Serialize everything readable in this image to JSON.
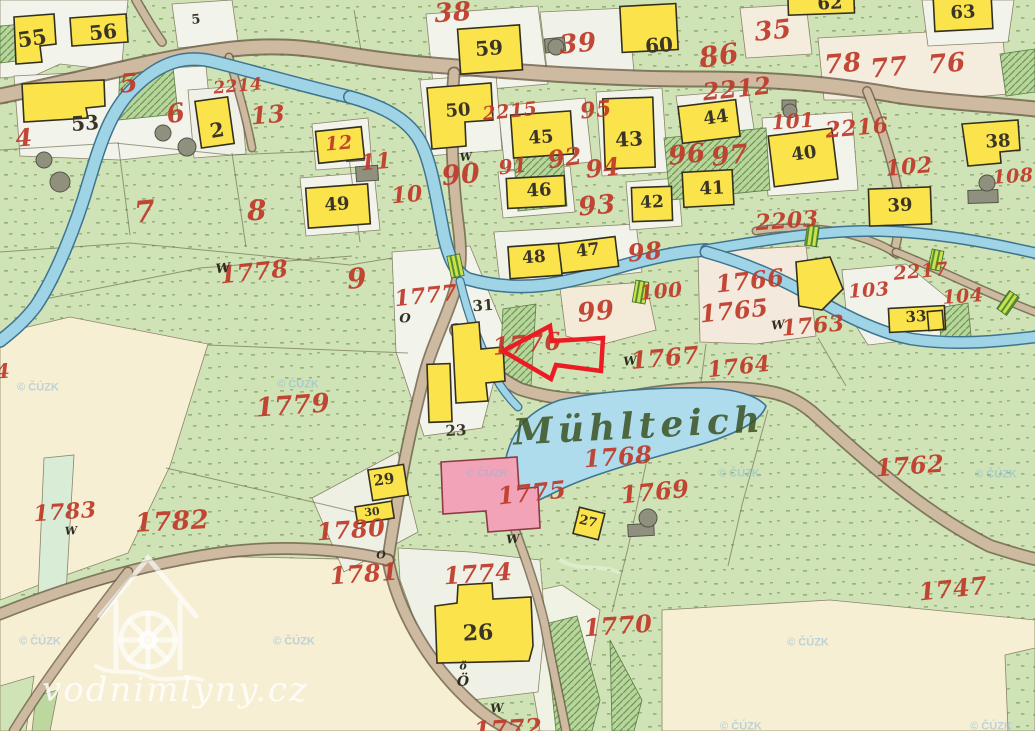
{
  "map": {
    "title": "Historical cadastral map sheet (Mühlteich mill pond)",
    "watermark": {
      "site": "vodnimlyny.cz",
      "copyright": "© ČÚZK"
    },
    "labels": {
      "red": [
        {
          "t": "38",
          "x": 453,
          "y": 13,
          "s": 26,
          "r": -4
        },
        {
          "t": "39",
          "x": 578,
          "y": 44,
          "s": 26,
          "r": -5
        },
        {
          "t": "35",
          "x": 773,
          "y": 31,
          "s": 26,
          "r": -6
        },
        {
          "t": "86",
          "x": 719,
          "y": 56,
          "s": 28,
          "r": -8
        },
        {
          "t": "78",
          "x": 843,
          "y": 64,
          "s": 26,
          "r": -5
        },
        {
          "t": "77",
          "x": 889,
          "y": 68,
          "s": 26,
          "r": -5
        },
        {
          "t": "76",
          "x": 947,
          "y": 64,
          "s": 26,
          "r": -5
        },
        {
          "t": "2212",
          "x": 737,
          "y": 89,
          "s": 24,
          "r": -6
        },
        {
          "t": "5",
          "x": 129,
          "y": 84,
          "s": 26,
          "r": -5
        },
        {
          "t": "2214",
          "x": 238,
          "y": 87,
          "s": 17,
          "r": -5
        },
        {
          "t": "13",
          "x": 268,
          "y": 115,
          "s": 24,
          "r": -5
        },
        {
          "t": "6",
          "x": 176,
          "y": 114,
          "s": 26,
          "r": -8
        },
        {
          "t": "12",
          "x": 339,
          "y": 144,
          "s": 19,
          "r": -5
        },
        {
          "t": "11",
          "x": 376,
          "y": 162,
          "s": 22,
          "r": -5
        },
        {
          "t": "10",
          "x": 407,
          "y": 195,
          "s": 22,
          "r": -5
        },
        {
          "t": "4",
          "x": 24,
          "y": 138,
          "s": 24,
          "r": -5
        },
        {
          "t": "7",
          "x": 145,
          "y": 213,
          "s": 30,
          "r": -5
        },
        {
          "t": "8",
          "x": 257,
          "y": 211,
          "s": 28,
          "r": -3
        },
        {
          "t": "9",
          "x": 357,
          "y": 279,
          "s": 28,
          "r": -5
        },
        {
          "t": "2215",
          "x": 510,
          "y": 112,
          "s": 19,
          "r": -6
        },
        {
          "t": "95",
          "x": 596,
          "y": 110,
          "s": 22,
          "r": -6
        },
        {
          "t": "92",
          "x": 565,
          "y": 158,
          "s": 24,
          "r": -8
        },
        {
          "t": "94",
          "x": 603,
          "y": 168,
          "s": 24,
          "r": -6
        },
        {
          "t": "91",
          "x": 513,
          "y": 166,
          "s": 20,
          "r": -6
        },
        {
          "t": "90",
          "x": 461,
          "y": 175,
          "s": 27,
          "r": -5
        },
        {
          "t": "93",
          "x": 597,
          "y": 206,
          "s": 26,
          "r": -5
        },
        {
          "t": "96",
          "x": 687,
          "y": 155,
          "s": 26,
          "r": -6
        },
        {
          "t": "97",
          "x": 730,
          "y": 156,
          "s": 26,
          "r": -6
        },
        {
          "t": "101",
          "x": 793,
          "y": 121,
          "s": 20,
          "r": -4
        },
        {
          "t": "2216",
          "x": 857,
          "y": 128,
          "s": 22,
          "r": -5
        },
        {
          "t": "102",
          "x": 909,
          "y": 167,
          "s": 22,
          "r": -5
        },
        {
          "t": "108",
          "x": 1013,
          "y": 177,
          "s": 19,
          "r": -4
        },
        {
          "t": "2203",
          "x": 787,
          "y": 221,
          "s": 22,
          "r": -4
        },
        {
          "t": "2217",
          "x": 921,
          "y": 272,
          "s": 19,
          "r": -5
        },
        {
          "t": "104",
          "x": 963,
          "y": 297,
          "s": 19,
          "r": -4
        },
        {
          "t": "103",
          "x": 869,
          "y": 291,
          "s": 19,
          "r": -4
        },
        {
          "t": "1766",
          "x": 750,
          "y": 281,
          "s": 24,
          "r": -6
        },
        {
          "t": "1765",
          "x": 734,
          "y": 311,
          "s": 24,
          "r": -6
        },
        {
          "t": "1763",
          "x": 813,
          "y": 326,
          "s": 22,
          "r": -5
        },
        {
          "t": "1764",
          "x": 739,
          "y": 367,
          "s": 22,
          "r": -6
        },
        {
          "t": "98",
          "x": 645,
          "y": 252,
          "s": 24,
          "r": -6
        },
        {
          "t": "100",
          "x": 661,
          "y": 291,
          "s": 20,
          "r": -5
        },
        {
          "t": "99",
          "x": 596,
          "y": 312,
          "s": 26,
          "r": -6
        },
        {
          "t": "1777",
          "x": 426,
          "y": 296,
          "s": 22,
          "r": -6
        },
        {
          "t": "1776",
          "x": 527,
          "y": 344,
          "s": 24,
          "r": -5
        },
        {
          "t": "1767",
          "x": 665,
          "y": 358,
          "s": 24,
          "r": -5
        },
        {
          "t": "1778",
          "x": 254,
          "y": 272,
          "s": 24,
          "r": -6
        },
        {
          "t": "1779",
          "x": 293,
          "y": 406,
          "s": 26,
          "r": -4
        },
        {
          "t": "1768",
          "x": 618,
          "y": 457,
          "s": 24,
          "r": -4
        },
        {
          "t": "1769",
          "x": 655,
          "y": 492,
          "s": 24,
          "r": -6
        },
        {
          "t": "1775",
          "x": 532,
          "y": 493,
          "s": 24,
          "r": -6
        },
        {
          "t": "1762",
          "x": 910,
          "y": 466,
          "s": 24,
          "r": -4
        },
        {
          "t": "1783",
          "x": 65,
          "y": 512,
          "s": 22,
          "r": -4
        },
        {
          "t": "1782",
          "x": 172,
          "y": 522,
          "s": 26,
          "r": -3
        },
        {
          "t": "1780",
          "x": 351,
          "y": 530,
          "s": 24,
          "r": -4
        },
        {
          "t": "1781",
          "x": 364,
          "y": 574,
          "s": 24,
          "r": -4
        },
        {
          "t": "1774",
          "x": 478,
          "y": 574,
          "s": 24,
          "r": -4
        },
        {
          "t": "1770",
          "x": 618,
          "y": 626,
          "s": 24,
          "r": -4
        },
        {
          "t": "1747",
          "x": 953,
          "y": 589,
          "s": 24,
          "r": -6
        },
        {
          "t": "1772",
          "x": 508,
          "y": 729,
          "s": 24,
          "r": -3
        },
        {
          "t": "4",
          "x": 3,
          "y": 371,
          "s": 20,
          "r": -4
        }
      ],
      "black": [
        {
          "t": "55",
          "x": 32,
          "y": 38,
          "s": 21,
          "r": -8
        },
        {
          "t": "56",
          "x": 103,
          "y": 32,
          "s": 20,
          "r": -6
        },
        {
          "t": "5",
          "x": 196,
          "y": 20,
          "s": 13,
          "r": -5
        },
        {
          "t": "53",
          "x": 85,
          "y": 123,
          "s": 20,
          "r": -4
        },
        {
          "t": "2",
          "x": 217,
          "y": 130,
          "s": 20,
          "r": -10
        },
        {
          "t": "59",
          "x": 489,
          "y": 48,
          "s": 20,
          "r": -4
        },
        {
          "t": "60",
          "x": 659,
          "y": 45,
          "s": 20,
          "r": -4
        },
        {
          "t": "62",
          "x": 830,
          "y": 4,
          "s": 18,
          "r": -3
        },
        {
          "t": "63",
          "x": 963,
          "y": 13,
          "s": 18,
          "r": -3
        },
        {
          "t": "50",
          "x": 458,
          "y": 111,
          "s": 18,
          "r": -4
        },
        {
          "t": "45",
          "x": 541,
          "y": 138,
          "s": 18,
          "r": -4
        },
        {
          "t": "43",
          "x": 629,
          "y": 139,
          "s": 20,
          "r": -3
        },
        {
          "t": "46",
          "x": 539,
          "y": 191,
          "s": 18,
          "r": -3
        },
        {
          "t": "42",
          "x": 652,
          "y": 203,
          "s": 17,
          "r": -3
        },
        {
          "t": "44",
          "x": 716,
          "y": 118,
          "s": 18,
          "r": -8
        },
        {
          "t": "40",
          "x": 804,
          "y": 154,
          "s": 18,
          "r": -8
        },
        {
          "t": "41",
          "x": 712,
          "y": 189,
          "s": 18,
          "r": -3
        },
        {
          "t": "38",
          "x": 998,
          "y": 142,
          "s": 18,
          "r": -3
        },
        {
          "t": "39",
          "x": 900,
          "y": 206,
          "s": 18,
          "r": -3
        },
        {
          "t": "49",
          "x": 337,
          "y": 205,
          "s": 18,
          "r": -4
        },
        {
          "t": "48",
          "x": 534,
          "y": 258,
          "s": 17,
          "r": -4
        },
        {
          "t": "47",
          "x": 588,
          "y": 251,
          "s": 17,
          "r": -7
        },
        {
          "t": "33",
          "x": 916,
          "y": 317,
          "s": 15,
          "r": -4
        },
        {
          "t": "31",
          "x": 483,
          "y": 306,
          "s": 15,
          "r": -4
        },
        {
          "t": "23",
          "x": 456,
          "y": 431,
          "s": 15,
          "r": -3
        },
        {
          "t": "29",
          "x": 384,
          "y": 480,
          "s": 15,
          "r": -8
        },
        {
          "t": "30",
          "x": 372,
          "y": 512,
          "s": 11,
          "r": -6
        },
        {
          "t": "26",
          "x": 478,
          "y": 633,
          "s": 22,
          "r": -3
        },
        {
          "t": "27",
          "x": 588,
          "y": 522,
          "s": 13,
          "r": 14
        }
      ],
      "symbols": [
        {
          "t": "W",
          "x": 223,
          "y": 269,
          "s": 13,
          "r": -6
        },
        {
          "t": "W",
          "x": 466,
          "y": 157,
          "s": 11,
          "r": -6
        },
        {
          "t": "W",
          "x": 630,
          "y": 361,
          "s": 12,
          "r": -6
        },
        {
          "t": "W",
          "x": 778,
          "y": 325,
          "s": 12,
          "r": -6
        },
        {
          "t": "W",
          "x": 71,
          "y": 531,
          "s": 11,
          "r": -4
        },
        {
          "t": "W",
          "x": 513,
          "y": 539,
          "s": 12,
          "r": -4
        },
        {
          "t": "W",
          "x": 497,
          "y": 708,
          "s": 12,
          "r": -4
        },
        {
          "t": "O",
          "x": 405,
          "y": 319,
          "s": 13,
          "r": 0
        },
        {
          "t": "O",
          "x": 381,
          "y": 555,
          "s": 11,
          "r": 0
        },
        {
          "t": "ö",
          "x": 463,
          "y": 666,
          "s": 11,
          "r": 0
        },
        {
          "t": "Ö",
          "x": 463,
          "y": 682,
          "s": 14,
          "r": 0
        }
      ],
      "script": [
        {
          "t": "Mühlteich",
          "x": 639,
          "y": 426,
          "s": 36,
          "r": -3,
          "ls": 5
        }
      ],
      "copyright_marks": [
        {
          "t": "© ČÚZK",
          "x": 38,
          "y": 388,
          "s": 11,
          "r": 0
        },
        {
          "t": "© ČÚZK",
          "x": 298,
          "y": 385,
          "s": 11,
          "r": 0
        },
        {
          "t": "© ČÚZK",
          "x": 40,
          "y": 642,
          "s": 11,
          "r": 0
        },
        {
          "t": "© ČÚZK",
          "x": 294,
          "y": 642,
          "s": 11,
          "r": 0
        },
        {
          "t": "© ČÚZK",
          "x": 487,
          "y": 474,
          "s": 11,
          "r": 0
        },
        {
          "t": "© ČÚZK",
          "x": 739,
          "y": 474,
          "s": 11,
          "r": 0
        },
        {
          "t": "© ČÚZK",
          "x": 808,
          "y": 643,
          "s": 11,
          "r": 0
        },
        {
          "t": "© ČÚZK",
          "x": 996,
          "y": 475,
          "s": 11,
          "r": 0
        },
        {
          "t": "© ČÚZK",
          "x": 741,
          "y": 727,
          "s": 11,
          "r": 0
        },
        {
          "t": "© ČÚZK",
          "x": 991,
          "y": 727,
          "s": 11,
          "r": 0
        }
      ]
    }
  }
}
